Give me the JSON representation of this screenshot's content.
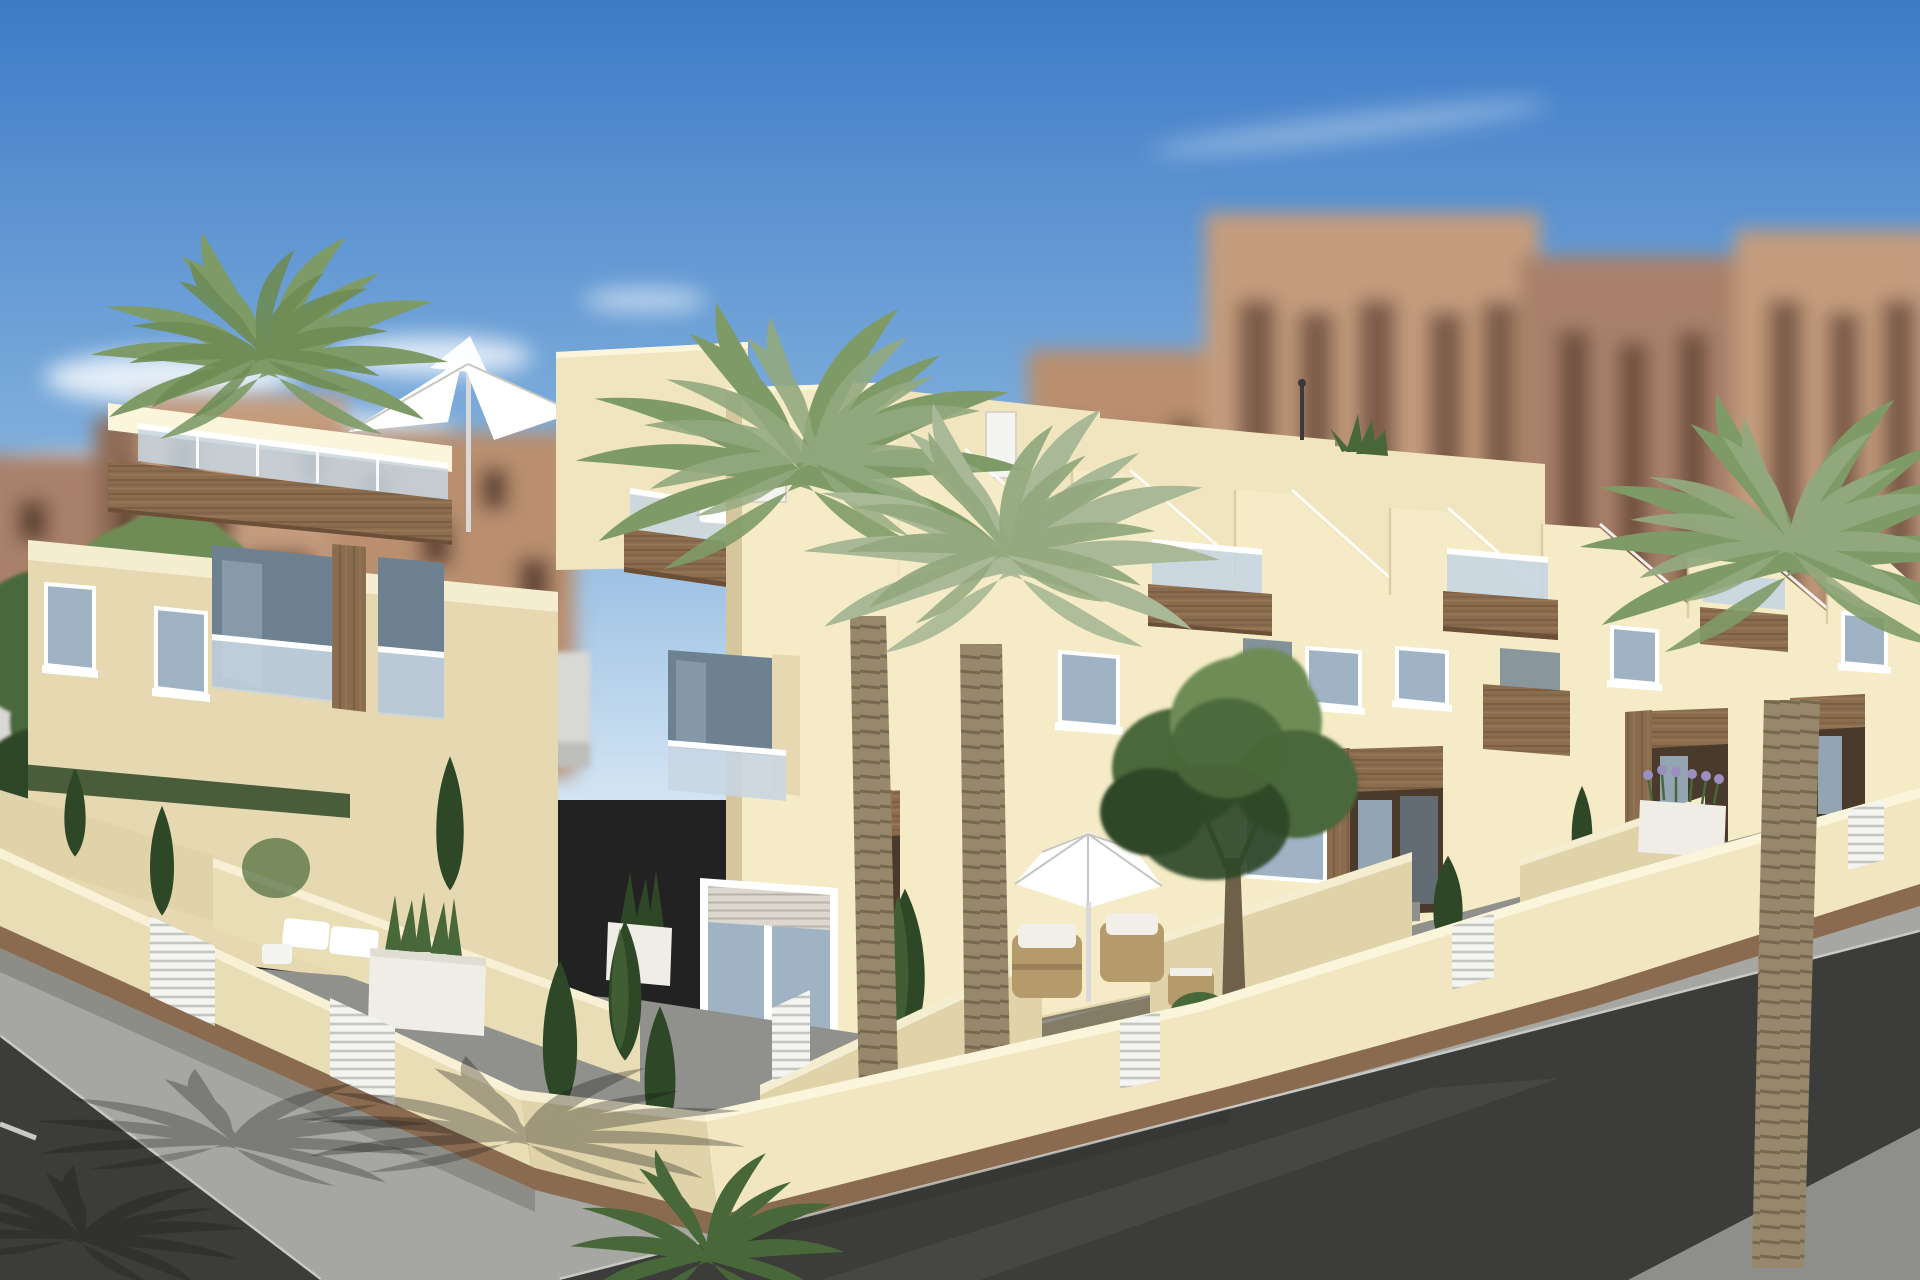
{
  "scene": {
    "title": "New-build corner townhouses — 3D architectural visualisation",
    "description": "Computer-generated render of a modern cream-coloured townhouse row on a street corner: stepped parapet rooflines, roof terraces with glass balustrades and white parasols, wood-clad balcony fascias and door surrounds, white-framed windows with roller shutters, walled front gardens with palm trees, cypress shrubs, white planters and rattan furniture, a beige perimeter wall with white slatted gates and brown base trim, grey pavements with palm shadows, dark asphalt streets with parking lines, and blurred tan apartment blocks under a blue sky.",
    "type": "architectural-render",
    "time_of_day": "day",
    "weather": "sunny, few thin clouds"
  },
  "elements": [
    "sky",
    "clouds",
    "blurred background apartment blocks",
    "white boundary wall",
    "townhouse row left wing",
    "corner unit tower",
    "right wing units",
    "roof terraces with glass railings",
    "folded white parasol on roof",
    "open white parasol on terrace",
    "wood-clad balcony fascias",
    "wood entrance door surrounds",
    "windows with roller shutters",
    "perimeter garden wall",
    "white slatted gates",
    "palm trees",
    "cypress shrubs",
    "deciduous trees",
    "white planter boxes with snake plants",
    "lavender planter",
    "rattan armchairs with white cushions",
    "white garden loungers",
    "sidewalk with palm shadows",
    "asphalt streets",
    "white parking lines",
    "roof antenna"
  ],
  "palette": {
    "sky_top": "#3D7BC7",
    "sky_mid": "#7FAEDC",
    "sky_low": "#D3E5F3",
    "cloud": "#FFFFFF",
    "bg_b1": "#B98F70",
    "bg_b2": "#A9816A",
    "bg_b3": "#C49B7D",
    "bg_b4": "#8F6C55",
    "bg_win": "#4F3529",
    "white_wall": "#D9D9D5",
    "white_wall_dark": "#BDBDB9",
    "fac_sun": "#F5EBC6",
    "fac_front": "#F0E5BE",
    "fac_shadow": "#E6D9B1",
    "fac_dark": "#D5C69D",
    "fac_top": "#FBF5DC",
    "wood": "#8A6C4E",
    "wood_dark": "#6B4F36",
    "wood_light": "#A5875F",
    "glass_light": "#C7D6E2",
    "glass_dark": "#6E8191",
    "win_glass": "#9FB3C4",
    "win_frame": "#FFFFFF",
    "shutter": "#DCD8CF",
    "shutter_line": "#B7B3AA",
    "door_recess": "#4A3A2C",
    "door_glass": "#93A4B2",
    "wall_cream": "#E9DDB5",
    "wall_cream_lit": "#F1E6BF",
    "wall_cream_sh": "#E0D3A9",
    "wall_base": "#8B6B4F",
    "gate": "#F4F4F1",
    "gate_line": "#C6C6C1",
    "pave": "#90908C",
    "pave_dark": "#7C7C78",
    "grass": "#56703F",
    "sidewalk": "#A6A6A2",
    "curb": "#C8C8C4",
    "street": "#3C3C3A",
    "street_light": "#565650",
    "street_pale": "#8E8E8A",
    "road_line": "#EDEDE9",
    "green_dark": "#2E4727",
    "green_mid": "#49683A",
    "green_lite": "#6E8C54",
    "palm1": "#7E9B67",
    "palm2": "#93A97E",
    "palm_pale": "#A9B896",
    "trunk": "#97876B",
    "trunk_dark": "#6F6049",
    "rattan": "#B59A6C",
    "cushion": "#F2EFE8",
    "lavender": "#9B8FC0",
    "planter": "#EFEDE6",
    "shadow": "#1A1A18",
    "pole": "#D9D9D9",
    "antenna": "#3A3A38"
  }
}
